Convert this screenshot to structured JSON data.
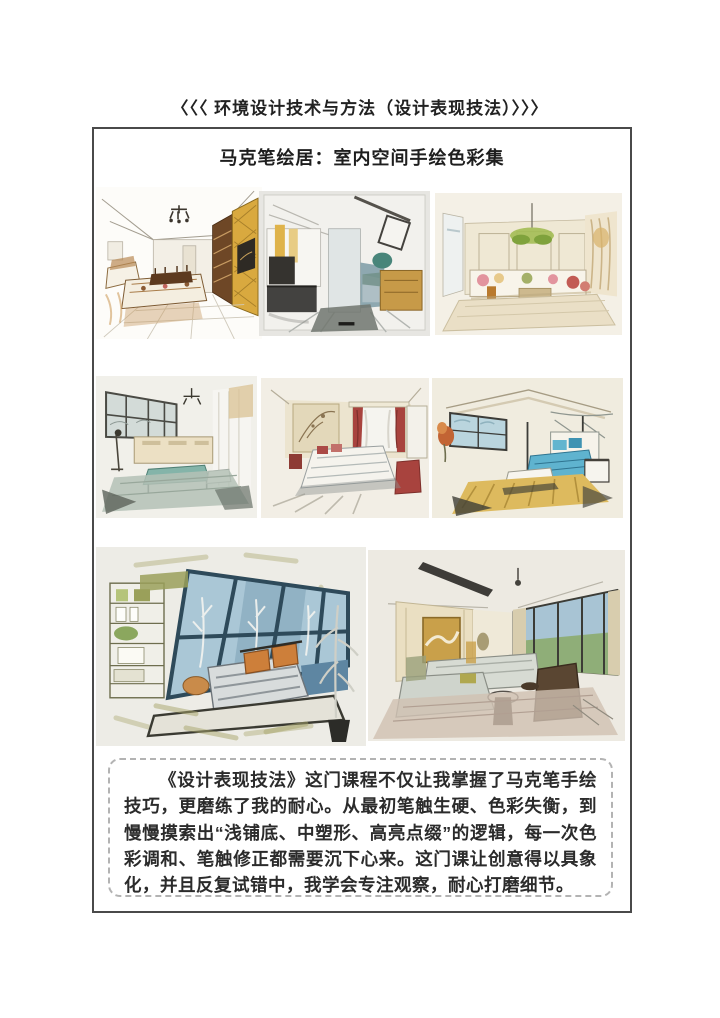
{
  "page": {
    "title": "〈〈〈 环境设计技术与方法（设计表现技法）〉〉〉",
    "heading": "马克笔绘居：室内空间手绘色彩集",
    "reflection": "《设计表现技法》这门课程不仅让我掌握了马克笔手绘技巧，更磨练了我的耐心。从最初笔触生硬、色彩失衡，到慢慢摸索出“浅铺底、中塑形、高亮点缀”的逻辑，每一次色彩调和、笔触修正都需要沉下心来。这门课让创意得以具象化，并且反复试错中，我学会专注观察，耐心打磨细节。",
    "palette": {
      "border_dark": "#4a4a4a",
      "dashed_border": "#b3b3b3",
      "marker_gold": "#d9a93f",
      "marker_teal": "#7fb2a8",
      "marker_blue_glass": "#aac7d6",
      "marker_orange": "#cd7f3a",
      "marker_red": "#a8433e",
      "marker_olive": "#9aa05a",
      "paper": "#edece6"
    }
  }
}
